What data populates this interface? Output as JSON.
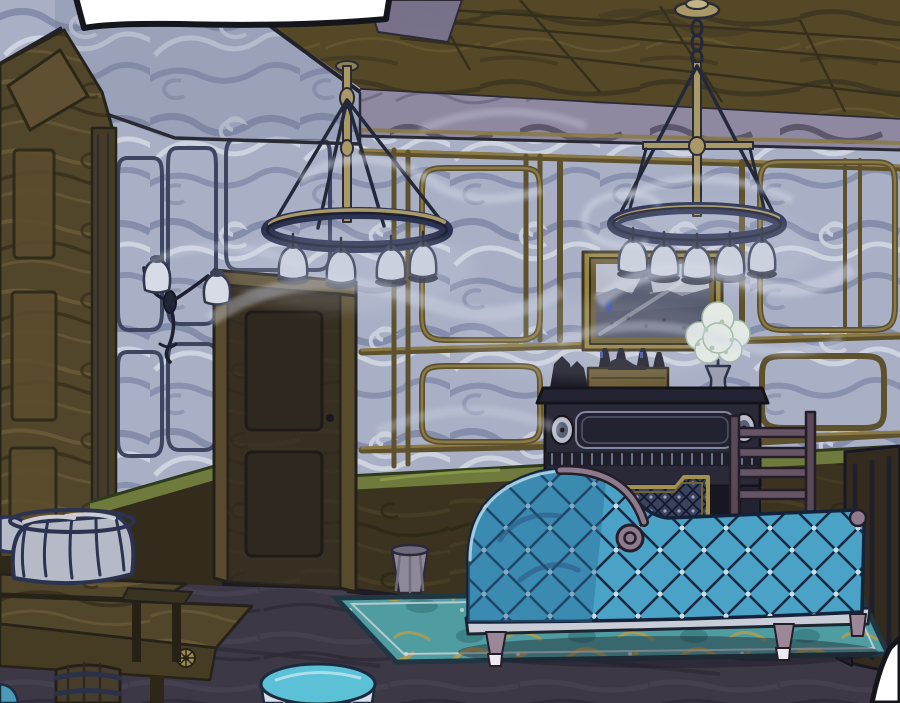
{
  "panel": {
    "kind": "comic-interior-illustration",
    "description": "Dim Victorian parlor with two brass chandeliers with glass bell shades, smoky swirled blue wallpaper with gold panel moldings, a framed painting, potted white plant on a dark mantel sideboard, lattice fire screen, wooden chair, tufted teal chaise sofa on a teal-and-gold rug, wooden door, wall sconce, wooden tables with a wire basket, barrel and round teal stool; empty white speech bubble at top left",
    "speech_bubble": {
      "text": ""
    },
    "objects": [
      "speech-bubble",
      "left-chandelier",
      "right-chandelier",
      "wall-sconce",
      "framed-painting",
      "potted-plant",
      "mantel-bottles",
      "fireplace-sideboard",
      "fire-screen",
      "wooden-chair",
      "chaise-sofa",
      "area-rug",
      "wooden-door",
      "wire-basket",
      "side-table",
      "foreground-table",
      "barrel",
      "waste-bin",
      "round-stool",
      "right-cabinet",
      "bubble-corner"
    ]
  },
  "palette": {
    "paper_white": "#ffffff",
    "ink": "#15151c",
    "wall_base": "#a9b0c6",
    "gold_molding": "#8c7a46",
    "ceiling_olive": "#554826",
    "frieze_grey": "#8e88a1",
    "wood_brown": "#51452a",
    "door_brown": "#453a23",
    "chair_rail_green": "#6e7b3c",
    "fireplace_dark": "#2a2937",
    "sofa_teal": "#4aa3c6",
    "sofa_shadow": "#2a6d99",
    "rug_teal": "#4f9da0",
    "rug_gold": "#b59d4e",
    "floor_dark": "#3d3846",
    "stool_teal": "#5cc0d6",
    "bin_grey": "#8e8899",
    "brass": "#a89966",
    "bell_glass": "#c9cfdc",
    "smoke": "#d5dae6",
    "leg_mauve": "#9c8798"
  }
}
